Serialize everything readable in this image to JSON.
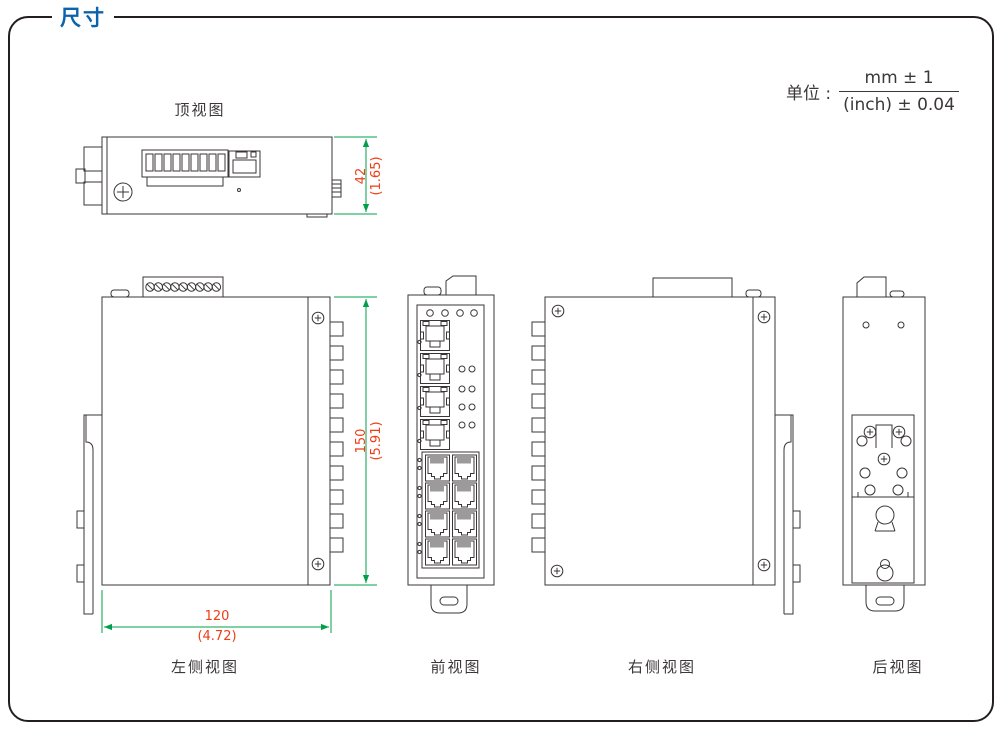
{
  "panel": {
    "title": "尺寸"
  },
  "unit": {
    "label": "单位 :",
    "numerator": "mm ± 1",
    "denominator": "(inch) ± 0.04"
  },
  "views": {
    "top": {
      "label": "顶视图"
    },
    "left": {
      "label": "左侧视图"
    },
    "front": {
      "label": "前视图"
    },
    "right": {
      "label": "右侧视图"
    },
    "rear": {
      "label": "后视图"
    }
  },
  "dimensions": {
    "thickness": {
      "mm": "42",
      "inch": "(1.65)"
    },
    "height": {
      "mm": "150",
      "inch": "(5.91)"
    },
    "depth": {
      "mm": "120",
      "inch": "(4.72)"
    }
  },
  "colors": {
    "accent_blue": "#0a64ad",
    "dimension_line_green": "#00a04b",
    "dimension_text_red": "#ee3d16",
    "line_art": "#3a3637"
  }
}
